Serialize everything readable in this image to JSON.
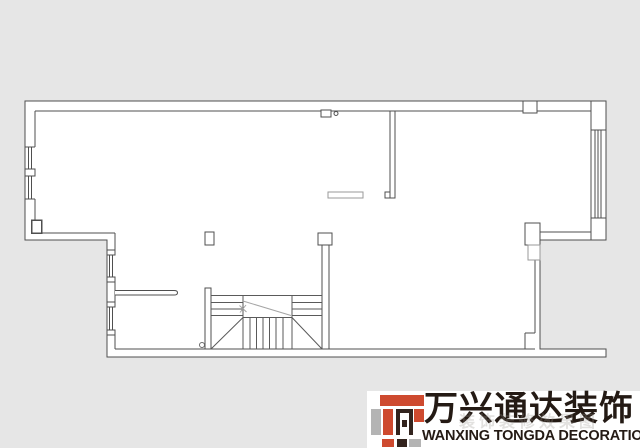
{
  "canvas": {
    "width": 640,
    "height": 448,
    "background_color": "#e6e6e6"
  },
  "floor_plan": {
    "description": "Architectural floor plan drawing of one storey, thin dark outlines on white floor area",
    "line_color": "#4f4f4f",
    "light_line_color": "#9a9a9a",
    "floor_color": "#ffffff",
    "features": [
      "exterior walls with step on lower left",
      "window with mullions on upper left wall",
      "two windows on lower left wall",
      "tall window on right wall between two piers",
      "interior partition hanging from top wall",
      "short partial wall with door opening",
      "staircase with treads, break diagonals and direction line",
      "columns and piers",
      "small wall notches",
      "recessed open terrace at lower right"
    ]
  },
  "logo": {
    "company_name_zh": "万兴通达装饰",
    "company_name_en": "WANXING TONGDA DECORATION",
    "watermark_ghost": "装饰装修效果图",
    "colors": {
      "red": "#ce4a2f",
      "gray": "#b4b4b4",
      "dark": "#33241e",
      "text": "#241a14",
      "panel": "#ffffff"
    }
  }
}
